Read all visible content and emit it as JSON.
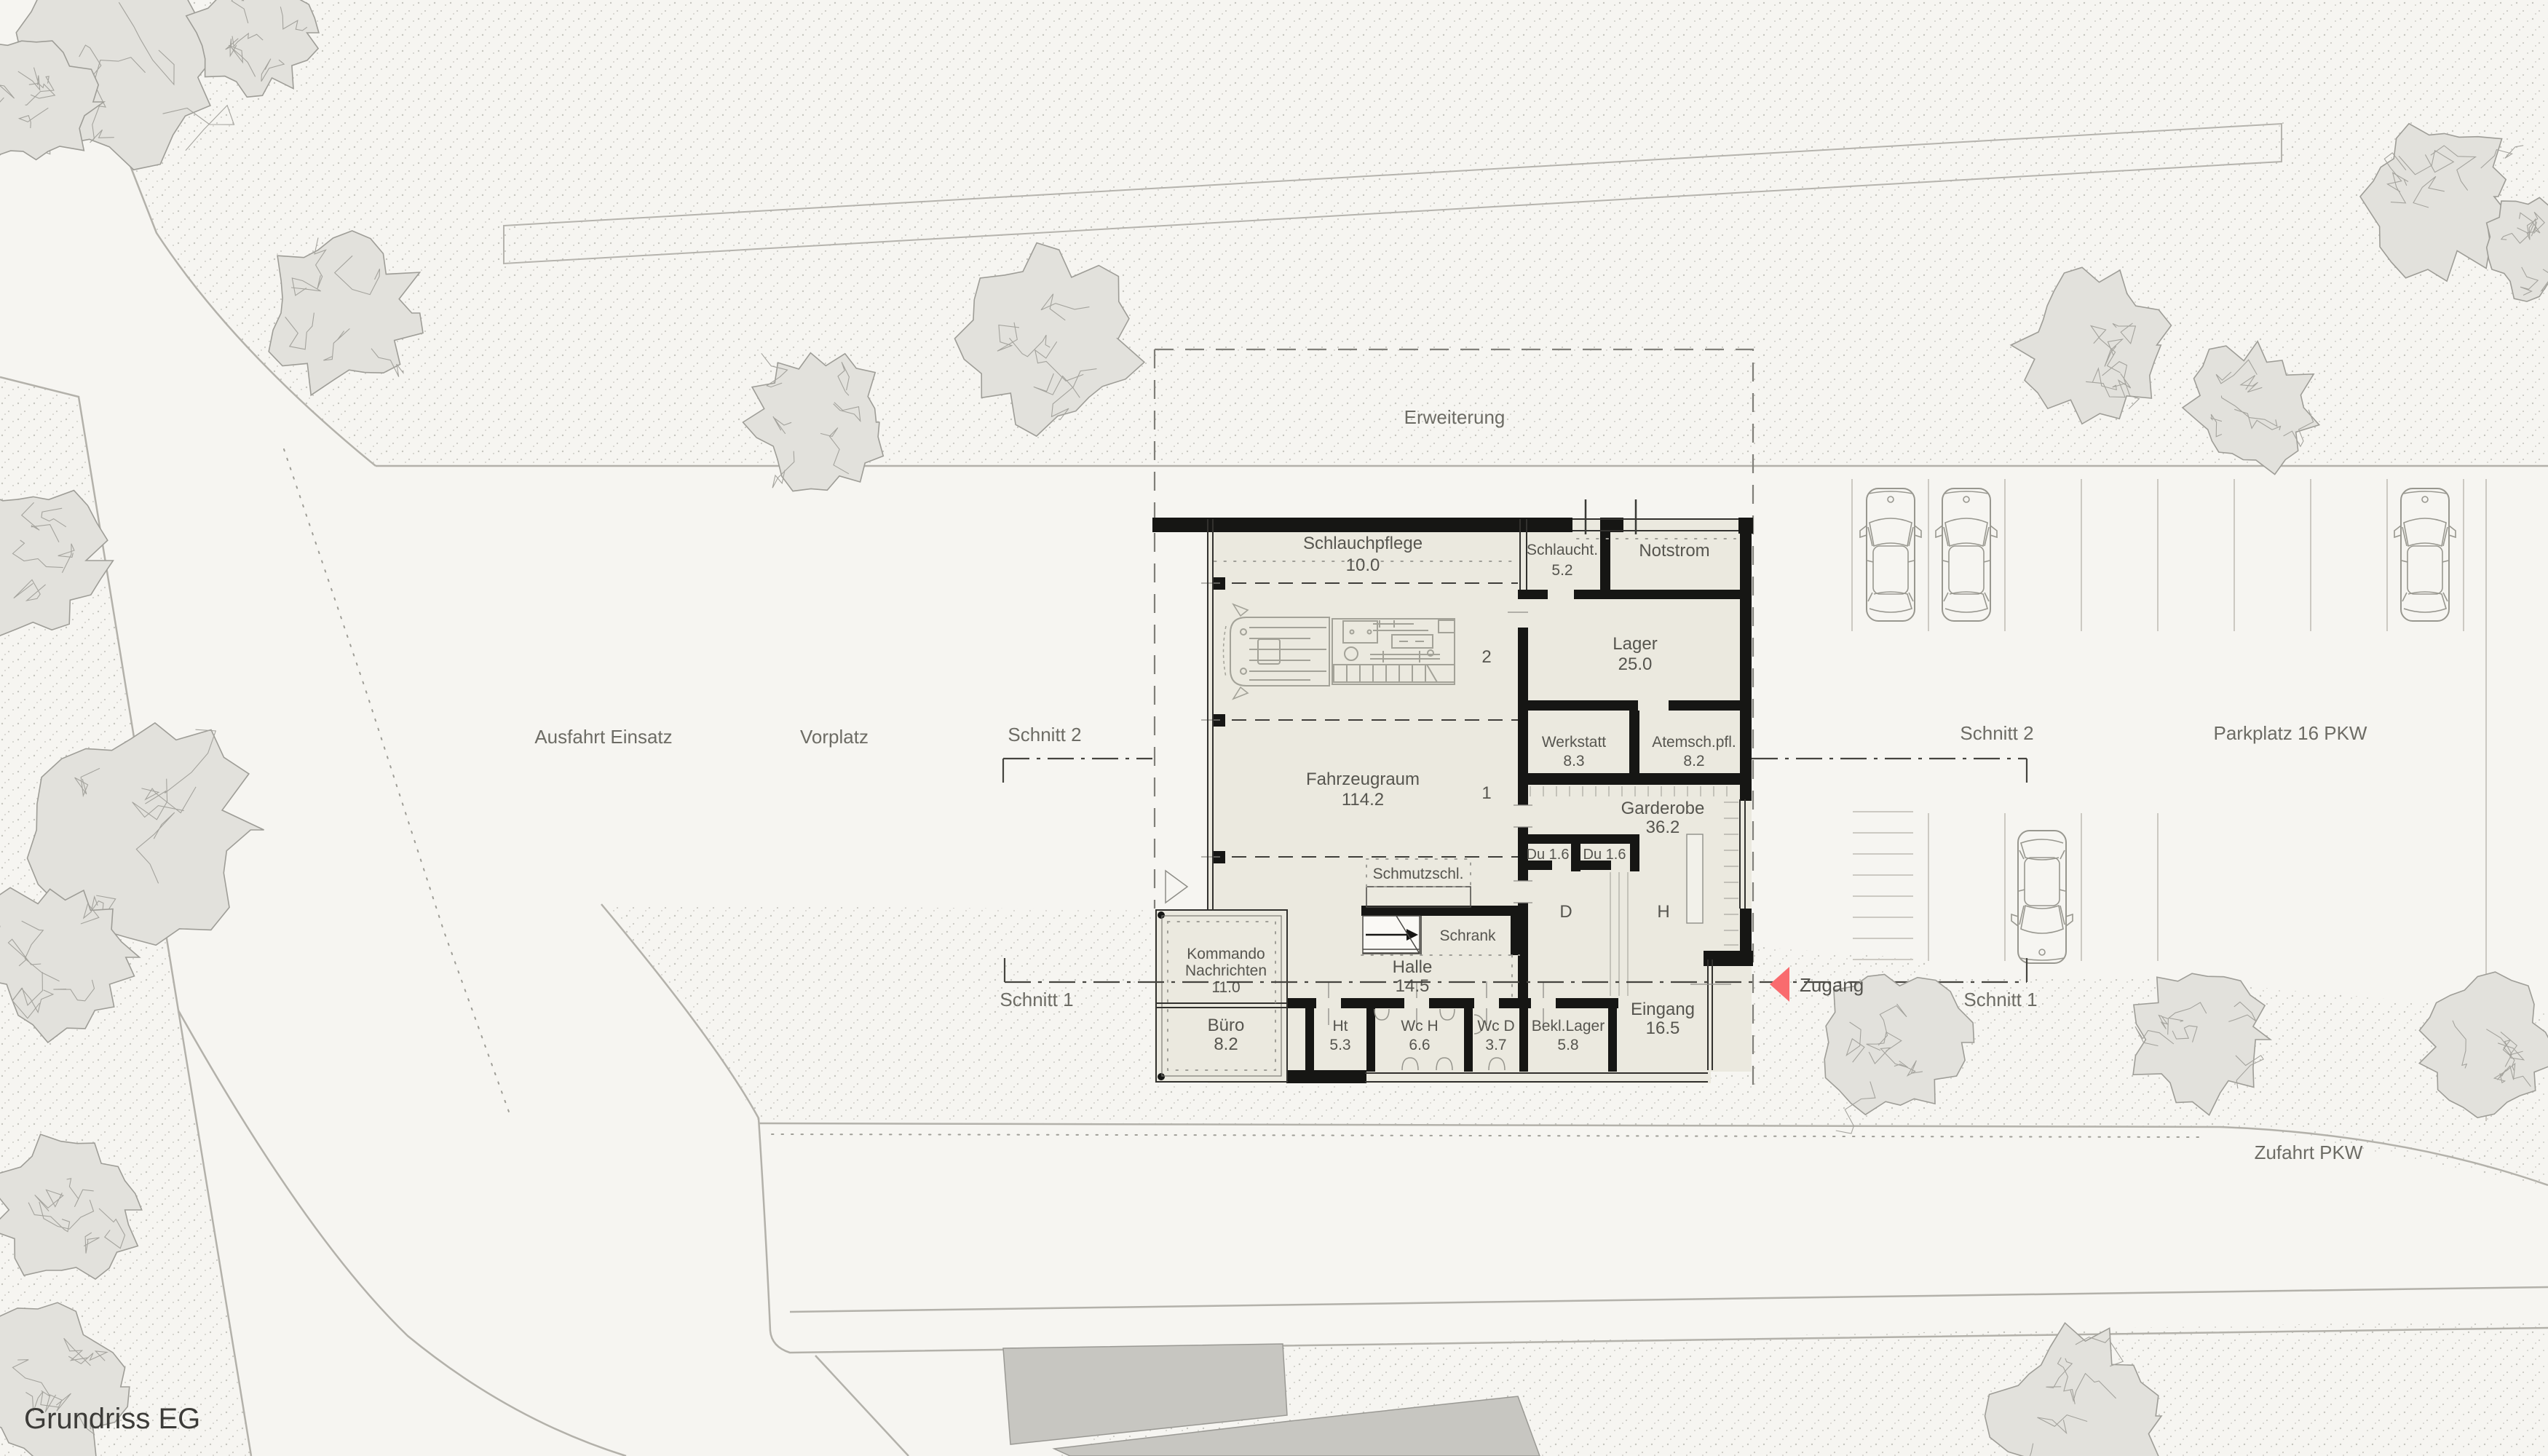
{
  "title": "Grundriss EG",
  "site": {
    "erweiterung": "Erweiterung",
    "ausfahrt_einsatz": "Ausfahrt Einsatz",
    "vorplatz": "Vorplatz",
    "parkplatz": "Parkplatz 16 PKW",
    "zufahrt_pkw": "Zufahrt PKW",
    "zugang": "Zugang",
    "schnitt_1": "Schnitt 1",
    "schnitt_2": "Schnitt 2"
  },
  "rooms": {
    "schlauchpflege": {
      "label": "Schlauchpflege",
      "area": "10.0"
    },
    "schlaucht": {
      "label": "Schlaucht.",
      "area": "5.2"
    },
    "notstrom": {
      "label": "Notstrom"
    },
    "lager": {
      "label": "Lager",
      "area": "25.0"
    },
    "werkstatt": {
      "label": "Werkstatt",
      "area": "8.3"
    },
    "atemschutz": {
      "label": "Atemsch.pfl.",
      "area": "8.2"
    },
    "fahrzeugraum": {
      "label": "Fahrzeugraum",
      "area": "114.2"
    },
    "garderobe": {
      "label": "Garderobe",
      "area": "36.2"
    },
    "dusche_1": {
      "label": "Du 1.6"
    },
    "dusche_2": {
      "label": "Du 1.6"
    },
    "damen": {
      "label": "D"
    },
    "herren": {
      "label": "H"
    },
    "schmutzschleuse": {
      "label": "Schmutzschl."
    },
    "schrank": {
      "label": "Schrank"
    },
    "halle": {
      "label": "Halle",
      "area": "14.5"
    },
    "kommando": {
      "label_line1": "Kommando",
      "label_line2": "Nachrichten",
      "area": "11.0"
    },
    "buero": {
      "label": "Büro",
      "area": "8.2"
    },
    "ht": {
      "label": "Ht",
      "area": "5.3"
    },
    "wc_h": {
      "label": "Wc H",
      "area": "6.6"
    },
    "wc_d": {
      "label": "Wc D",
      "area": "3.7"
    },
    "bekleidungslager": {
      "label": "Bekl.Lager",
      "area": "5.8"
    },
    "eingang": {
      "label": "Eingang",
      "area": "16.5"
    }
  },
  "lanes": {
    "lane_1": "1",
    "lane_2": "2"
  },
  "colors": {
    "accent_arrow": "#f96b6e",
    "wall": "#161614",
    "room_fill": "#ebe9df",
    "paper": "#f6f5f1",
    "label_gray": "#6d6c65"
  }
}
